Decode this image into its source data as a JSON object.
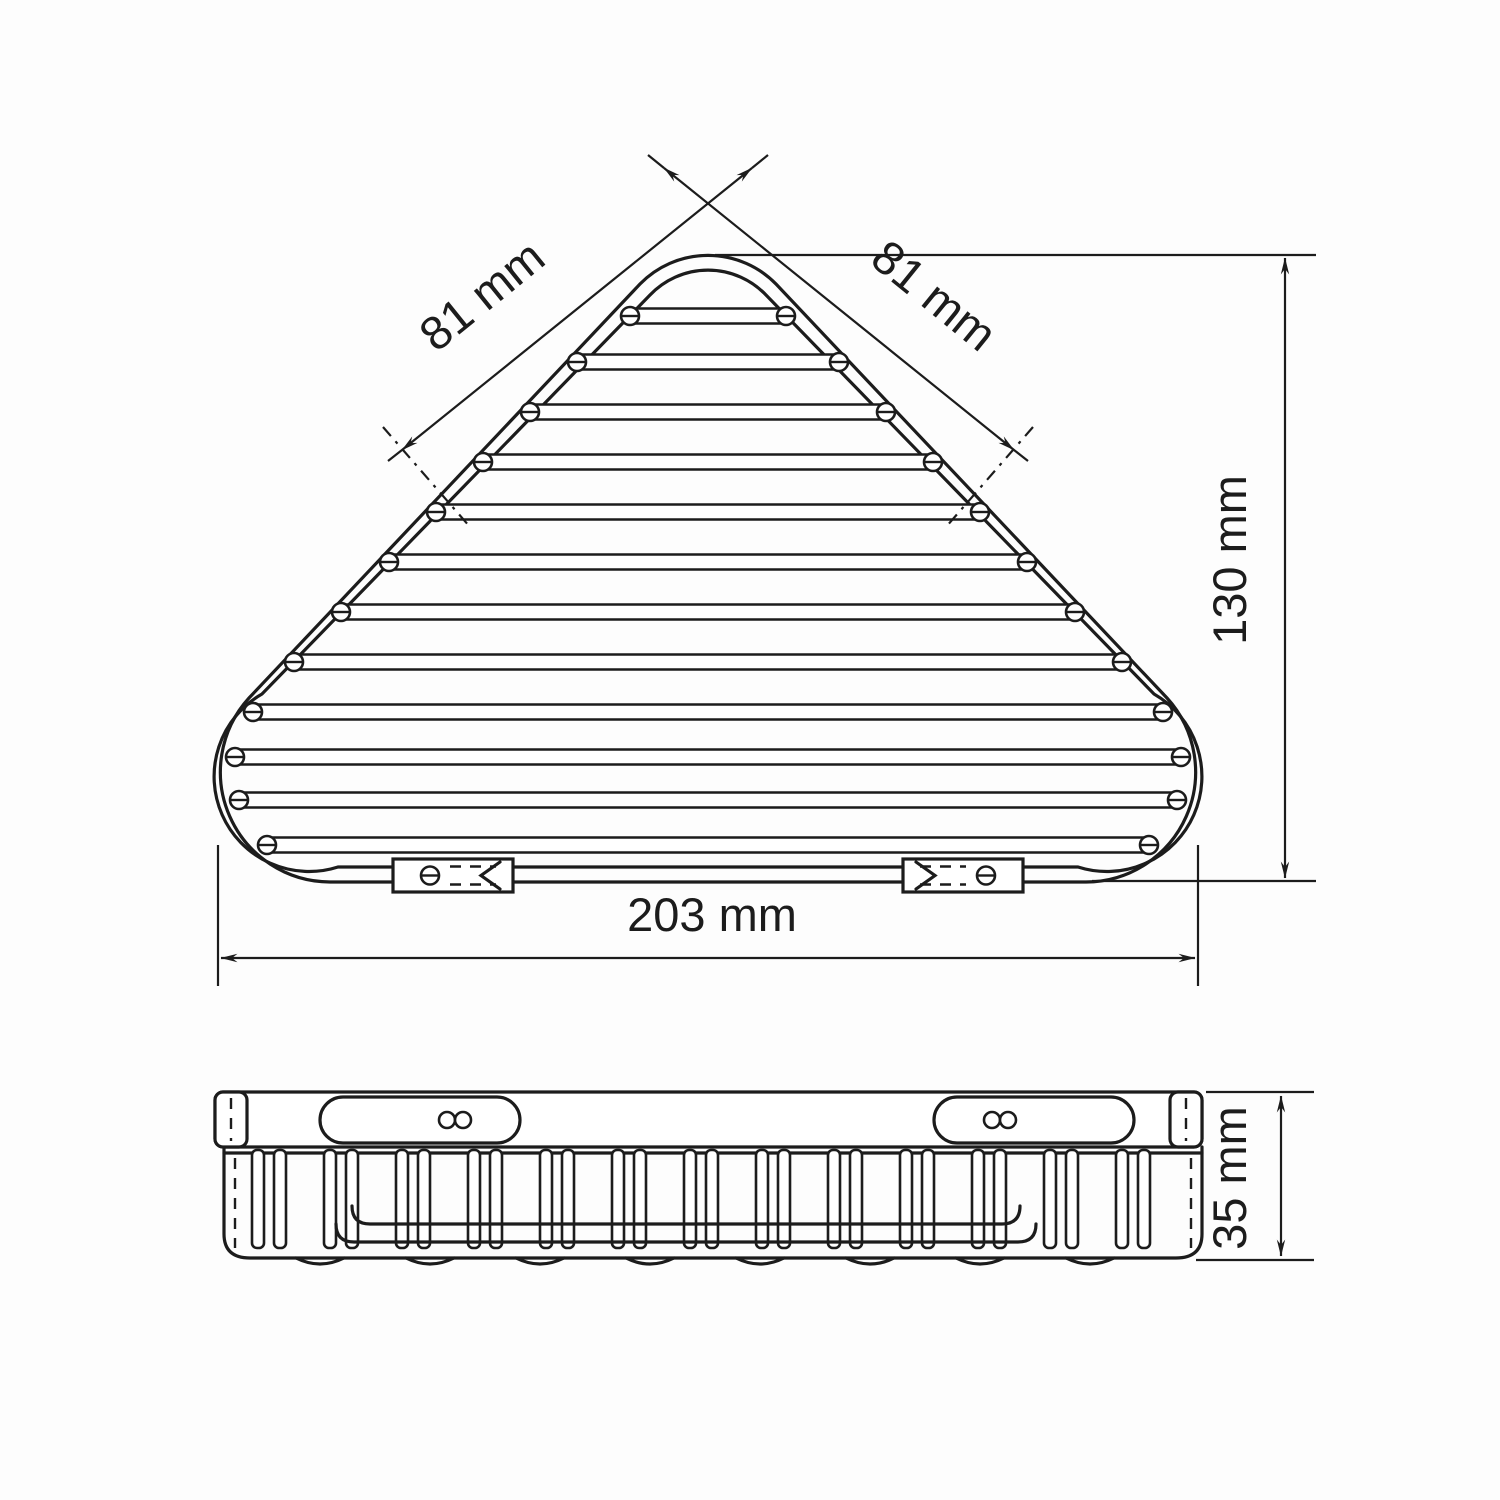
{
  "drawing": {
    "type": "technical dimensional drawing",
    "subject": "corner wire shower basket",
    "dimensions": {
      "left_edge": "81 mm",
      "right_edge": "81 mm",
      "height": "130 mm",
      "width": "203 mm",
      "side_height": "35 mm"
    },
    "colors": {
      "line": "#1c1c1c",
      "background": "#ffffff"
    }
  }
}
